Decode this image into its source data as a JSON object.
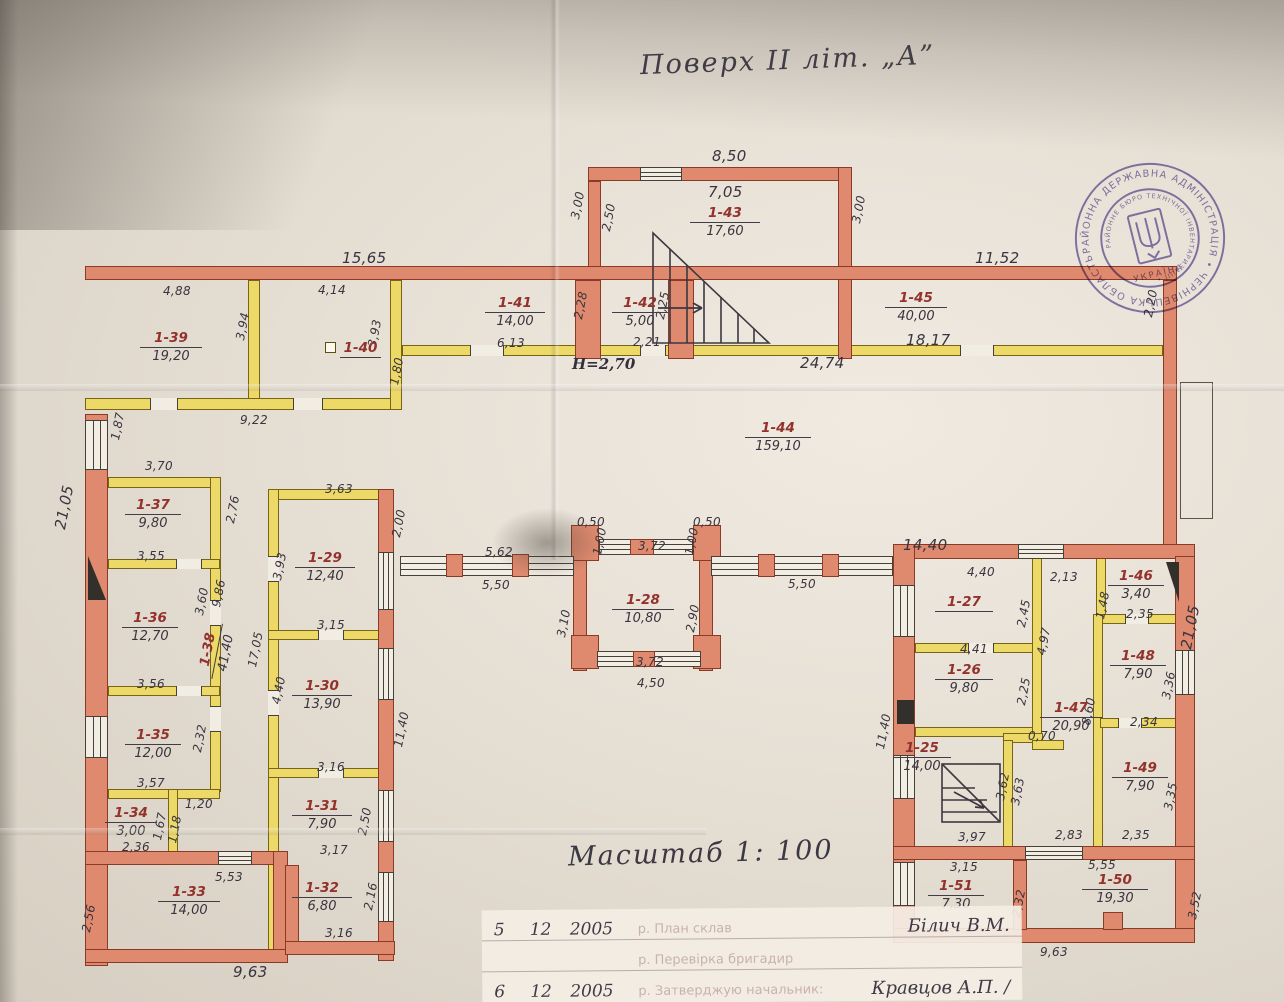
{
  "title": "Поверх ІІ літ. „А”",
  "scale_label": "Масштаб 1: 100",
  "stamp": {
    "ring_text": "РАЙОННА ДЕРЖАВНА АДМІНІСТРАЦІЯ • ЧЕРНІВЕЦЬКА ОБЛАСТЬ •",
    "inner_text": "РАЙОННЕ БЮРО ТЕХНІЧНОЇ ІНВЕНТАРИЗАЦІЇ •",
    "country": "УКРАЇНА"
  },
  "footer": {
    "rows": [
      {
        "n": "5",
        "d": "12",
        "y": "2005",
        "printed": "р. План склав",
        "sig": "Білич В.М."
      },
      {
        "n": "",
        "d": "",
        "y": "",
        "printed": "р. Перевірка бригадир",
        "sig": ""
      },
      {
        "n": "6",
        "d": "12",
        "y": "2005",
        "printed": "р. Затверджую начальник:",
        "sig": "Кравцов А.П. /"
      }
    ]
  },
  "rooms": {
    "r25": {
      "num": "1-25",
      "area": "14,00"
    },
    "r26": {
      "num": "1-26",
      "area": "9,80"
    },
    "r27": {
      "num": "1-27",
      "area": ""
    },
    "r28": {
      "num": "1-28",
      "area": "10,80"
    },
    "r29": {
      "num": "1-29",
      "area": "12,40"
    },
    "r30": {
      "num": "1-30",
      "area": "13,90"
    },
    "r31": {
      "num": "1-31",
      "area": "7,90"
    },
    "r32": {
      "num": "1-32",
      "area": "6,80"
    },
    "r33": {
      "num": "1-33",
      "area": "14,00"
    },
    "r34": {
      "num": "1-34",
      "area": "3,00"
    },
    "r35": {
      "num": "1-35",
      "area": "12,00"
    },
    "r36": {
      "num": "1-36",
      "area": "12,70"
    },
    "r37": {
      "num": "1-37",
      "area": "9,80"
    },
    "r38": {
      "num": "1-38",
      "area": "41,40"
    },
    "r39": {
      "num": "1-39",
      "area": "19,20"
    },
    "r40": {
      "num": "1-40",
      "area": ""
    },
    "r41": {
      "num": "1-41",
      "area": "14,00"
    },
    "r42": {
      "num": "1-42",
      "area": "5,00"
    },
    "r43": {
      "num": "1-43",
      "area": "17,60"
    },
    "r44": {
      "num": "1-44",
      "area": "159,10"
    },
    "r45": {
      "num": "1-45",
      "area": "40,00"
    },
    "r46": {
      "num": "1-46",
      "area": "3,40"
    },
    "r47": {
      "num": "1-47",
      "area": "20,90"
    },
    "r48": {
      "num": "1-48",
      "area": "7,90"
    },
    "r49": {
      "num": "1-49",
      "area": "7,90"
    },
    "r50": {
      "num": "1-50",
      "area": "19,30"
    },
    "r51": {
      "num": "1-51",
      "area": "7,30"
    }
  },
  "dims": {
    "d01": "8,50",
    "d02": "7,05",
    "d03": "3,00",
    "d04": "2,50",
    "d05": "3,00",
    "d06": "15,65",
    "d07": "4,88",
    "d08": "4,14",
    "d09": "3,94",
    "d10": "3,93",
    "d11": "1,80",
    "d12": "9,22",
    "d13": "6,13",
    "d14": "2,28",
    "d15": "2,21",
    "d16": "2,25",
    "d17": "H=2,70",
    "d18": "11,52",
    "d19": "18,17",
    "d20": "24,74",
    "d21": "2,20",
    "d22": "1,87",
    "d23": "21,05",
    "d24": "3,70",
    "d25": "2,76",
    "d26": "3,55",
    "d27": "3,60",
    "d28": "9,86",
    "d29": "3,56",
    "d30": "2,32",
    "d31": "3,57",
    "d32": "1,20",
    "d33": "1,67",
    "d34": "1,18",
    "d35": "2,36",
    "d36": "5,53",
    "d37": "2,56",
    "d38": "9,63",
    "d39": "17,05",
    "d40": "3,63",
    "d41": "3,93",
    "d42": "2,00",
    "d43": "3,15",
    "d44": "4,40",
    "d45": "11,40",
    "d46": "3,16",
    "d47": "2,50",
    "d48": "3,17",
    "d49": "2,16",
    "d50": "3,16",
    "d51": "0,50",
    "d52": "1,00",
    "d53": "3,72",
    "d54": "0,50",
    "d55": "1,00",
    "d56": "5,62",
    "d57": "5,50",
    "d58": "3,10",
    "d59": "2,90",
    "d60": "3,72",
    "d61": "4,50",
    "d62": "5,50",
    "d63": "14,40",
    "d64": "4,40",
    "d65": "2,13",
    "d66": "2,45",
    "d67": "4,41",
    "d68": "2,25",
    "d69": "4,97",
    "d70": "11,40",
    "d71": "0,70",
    "d72": "8,60",
    "d73": "3,62",
    "d74": "3,63",
    "d75": "3,97",
    "d76": "2,83",
    "d77": "3,15",
    "d78": "5,55",
    "d79": "2,32",
    "d80": "3,52",
    "d81": "9,63",
    "d82": "1,48",
    "d83": "2,35",
    "d84": "3,36",
    "d85": "2,34",
    "d86": "3,35",
    "d87": "2,35",
    "d88": "21,05"
  }
}
